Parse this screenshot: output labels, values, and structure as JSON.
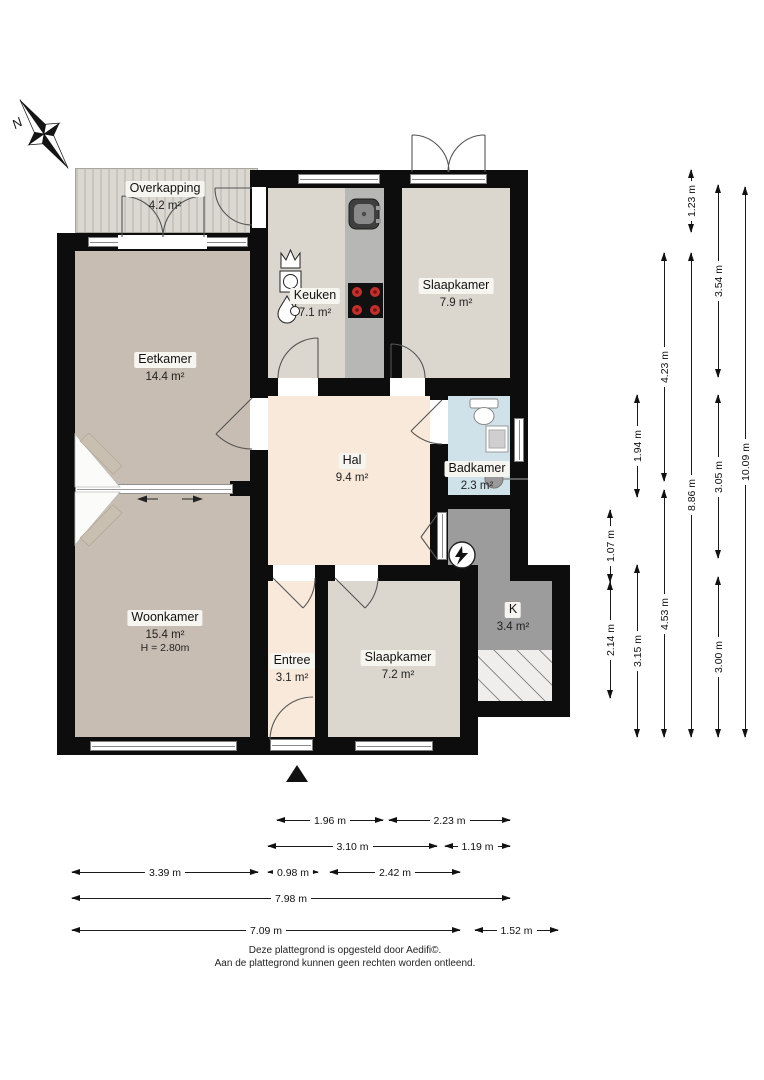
{
  "compass": {
    "label": "N"
  },
  "rooms": [
    {
      "id": "overkapping",
      "name": "Overkapping",
      "area": "4.2 m²"
    },
    {
      "id": "eetkamer",
      "name": "Eetkamer",
      "area": "14.4 m²"
    },
    {
      "id": "keuken",
      "name": "Keuken",
      "area": "7.1 m²"
    },
    {
      "id": "slaapkamer-1",
      "name": "Slaapkamer",
      "area": "7.9 m²"
    },
    {
      "id": "hal",
      "name": "Hal",
      "area": "9.4 m²"
    },
    {
      "id": "badkamer",
      "name": "Badkamer",
      "area": "2.3 m²"
    },
    {
      "id": "woonkamer",
      "name": "Woonkamer",
      "area": "15.4 m²",
      "height": "H = 2.80m"
    },
    {
      "id": "entree",
      "name": "Entree",
      "area": "3.1 m²"
    },
    {
      "id": "slaapkamer-2",
      "name": "Slaapkamer",
      "area": "7.2 m²"
    },
    {
      "id": "kast",
      "name": "K",
      "area": "3.4 m²"
    }
  ],
  "icons": {
    "compass": "north-arrow",
    "kitchen": [
      "crown-appliance",
      "washing-machine",
      "water-heater-drop",
      "sink",
      "stove"
    ],
    "bathroom": [
      "toilet",
      "washbasin",
      "shower-drain"
    ],
    "utility": [
      "electricity-meter"
    ],
    "entrance": "entrance-triangle"
  },
  "colors": {
    "wall": "#0d0d0d",
    "floor_warm": "#c8bdb2",
    "floor_light": "#dbd7cf",
    "hall_peach": "#f8e9da",
    "bath_blue": "#cfe2ea",
    "utility_gray": "#9c9c9c",
    "counter_gray": "#b7b7b5",
    "burner_red": "#c0312e"
  },
  "dims": {
    "vertical": [
      {
        "x": 610,
        "segments": [
          {
            "from": 510,
            "to": 582,
            "label": "1.07 m"
          },
          {
            "from": 582,
            "to": 698,
            "label": "2.14 m"
          }
        ]
      },
      {
        "x": 637,
        "segments": [
          {
            "from": 395,
            "to": 497,
            "label": "1.94 m"
          },
          {
            "from": 565,
            "to": 737,
            "label": "3.15 m"
          }
        ]
      },
      {
        "x": 664,
        "segments": [
          {
            "from": 253,
            "to": 481,
            "label": "4.23 m"
          },
          {
            "from": 490,
            "to": 737,
            "label": "4.53 m"
          }
        ]
      },
      {
        "x": 691,
        "segments": [
          {
            "from": 170,
            "to": 232,
            "label": "1.23 m"
          },
          {
            "from": 253,
            "to": 737,
            "label": "8.86 m"
          }
        ]
      },
      {
        "x": 718,
        "segments": [
          {
            "from": 185,
            "to": 377,
            "label": "3.54 m"
          },
          {
            "from": 395,
            "to": 558,
            "label": "3.05 m"
          },
          {
            "from": 577,
            "to": 737,
            "label": "3.00 m"
          }
        ]
      },
      {
        "x": 745,
        "segments": [
          {
            "from": 187,
            "to": 737,
            "label": "10.09 m"
          }
        ]
      }
    ],
    "horizontal": [
      {
        "y": 820,
        "segments": [
          {
            "from": 277,
            "to": 383,
            "label": "1.96 m"
          },
          {
            "from": 389,
            "to": 510,
            "label": "2.23 m"
          }
        ]
      },
      {
        "y": 846,
        "segments": [
          {
            "from": 268,
            "to": 437,
            "label": "3.10 m"
          },
          {
            "from": 445,
            "to": 510,
            "label": "1.19 m"
          }
        ]
      },
      {
        "y": 872,
        "segments": [
          {
            "from": 72,
            "to": 258,
            "label": "3.39 m"
          },
          {
            "from": 268,
            "to": 318,
            "label": "0.98 m"
          },
          {
            "from": 330,
            "to": 460,
            "label": "2.42 m"
          }
        ]
      },
      {
        "y": 898,
        "segments": [
          {
            "from": 72,
            "to": 510,
            "label": "7.98 m"
          }
        ]
      },
      {
        "y": 930,
        "segments": [
          {
            "from": 72,
            "to": 460,
            "label": "7.09 m"
          },
          {
            "from": 475,
            "to": 558,
            "label": "1.52 m"
          }
        ]
      }
    ]
  },
  "footer": {
    "line1": "Deze plattegrond is opgesteld door Aedifi©.",
    "line2": "Aan de plattegrond kunnen geen rechten worden ontleend."
  }
}
